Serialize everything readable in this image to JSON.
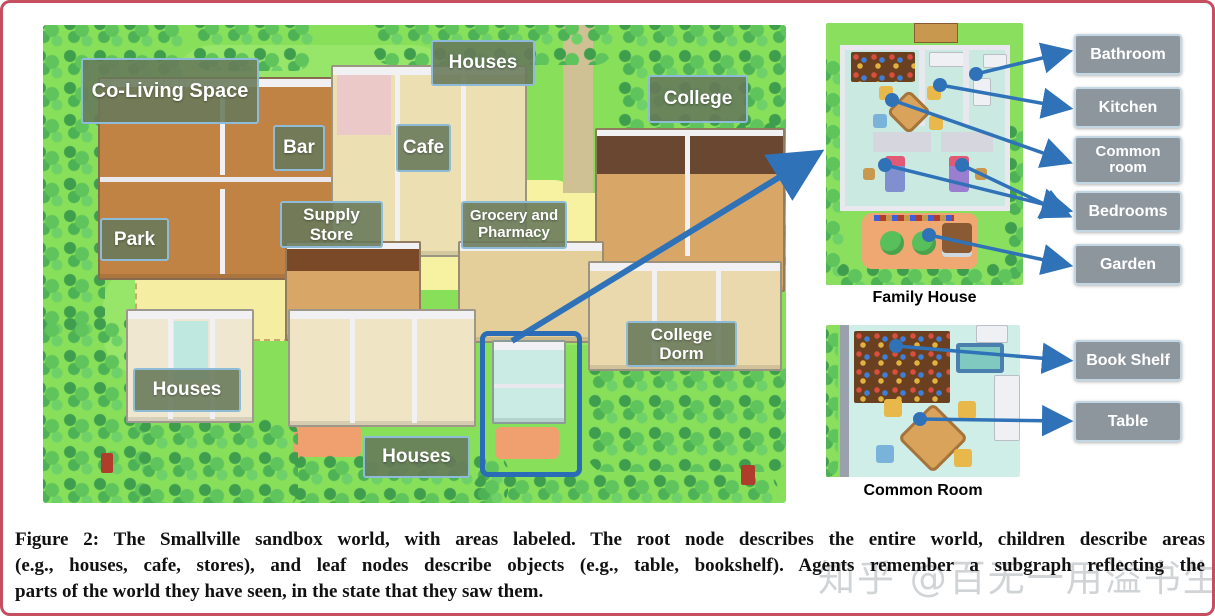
{
  "map": {
    "labels": [
      {
        "id": "co-living-space",
        "text": "Co-Living Space"
      },
      {
        "id": "houses-top",
        "text": "Houses"
      },
      {
        "id": "college",
        "text": "College"
      },
      {
        "id": "bar",
        "text": "Bar"
      },
      {
        "id": "cafe",
        "text": "Cafe"
      },
      {
        "id": "supply-store",
        "text": "Supply Store"
      },
      {
        "id": "grocery-pharmacy",
        "text": "Grocery and Pharmacy"
      },
      {
        "id": "park",
        "text": "Park"
      },
      {
        "id": "college-dorm",
        "text": "College Dorm"
      },
      {
        "id": "houses-bottom-left",
        "text": "Houses"
      },
      {
        "id": "houses-bottom-center",
        "text": "Houses"
      }
    ]
  },
  "insets": [
    {
      "title": "Family House",
      "callouts": [
        "Bathroom",
        "Kitchen",
        "Common room",
        "Bedrooms",
        "Garden"
      ]
    },
    {
      "title": "Common Room",
      "callouts": [
        "Book Shelf",
        "Table"
      ]
    }
  ],
  "caption_lines": [
    "Figure 2: The Smallville sandbox world, with areas labeled. The root node describes the entire world, children describe areas",
    "(e.g., houses, cafe, stores), and leaf nodes describe objects (e.g., table, bookshelf). Agents remember a subgraph reflecting the",
    "parts of the world they have seen, in the state that they saw them."
  ],
  "watermark": {
    "text": "知乎 @百无一用溢书生"
  },
  "colors": {
    "frame_border": "#c44f5e",
    "arrow_blue": "#2f72b8",
    "map_label_bg": "#68795a",
    "map_label_border": "#8ebcd8",
    "callout_bg": "#8e969d",
    "grass": "#87df5a",
    "path_yellow": "#f7f1a2"
  }
}
